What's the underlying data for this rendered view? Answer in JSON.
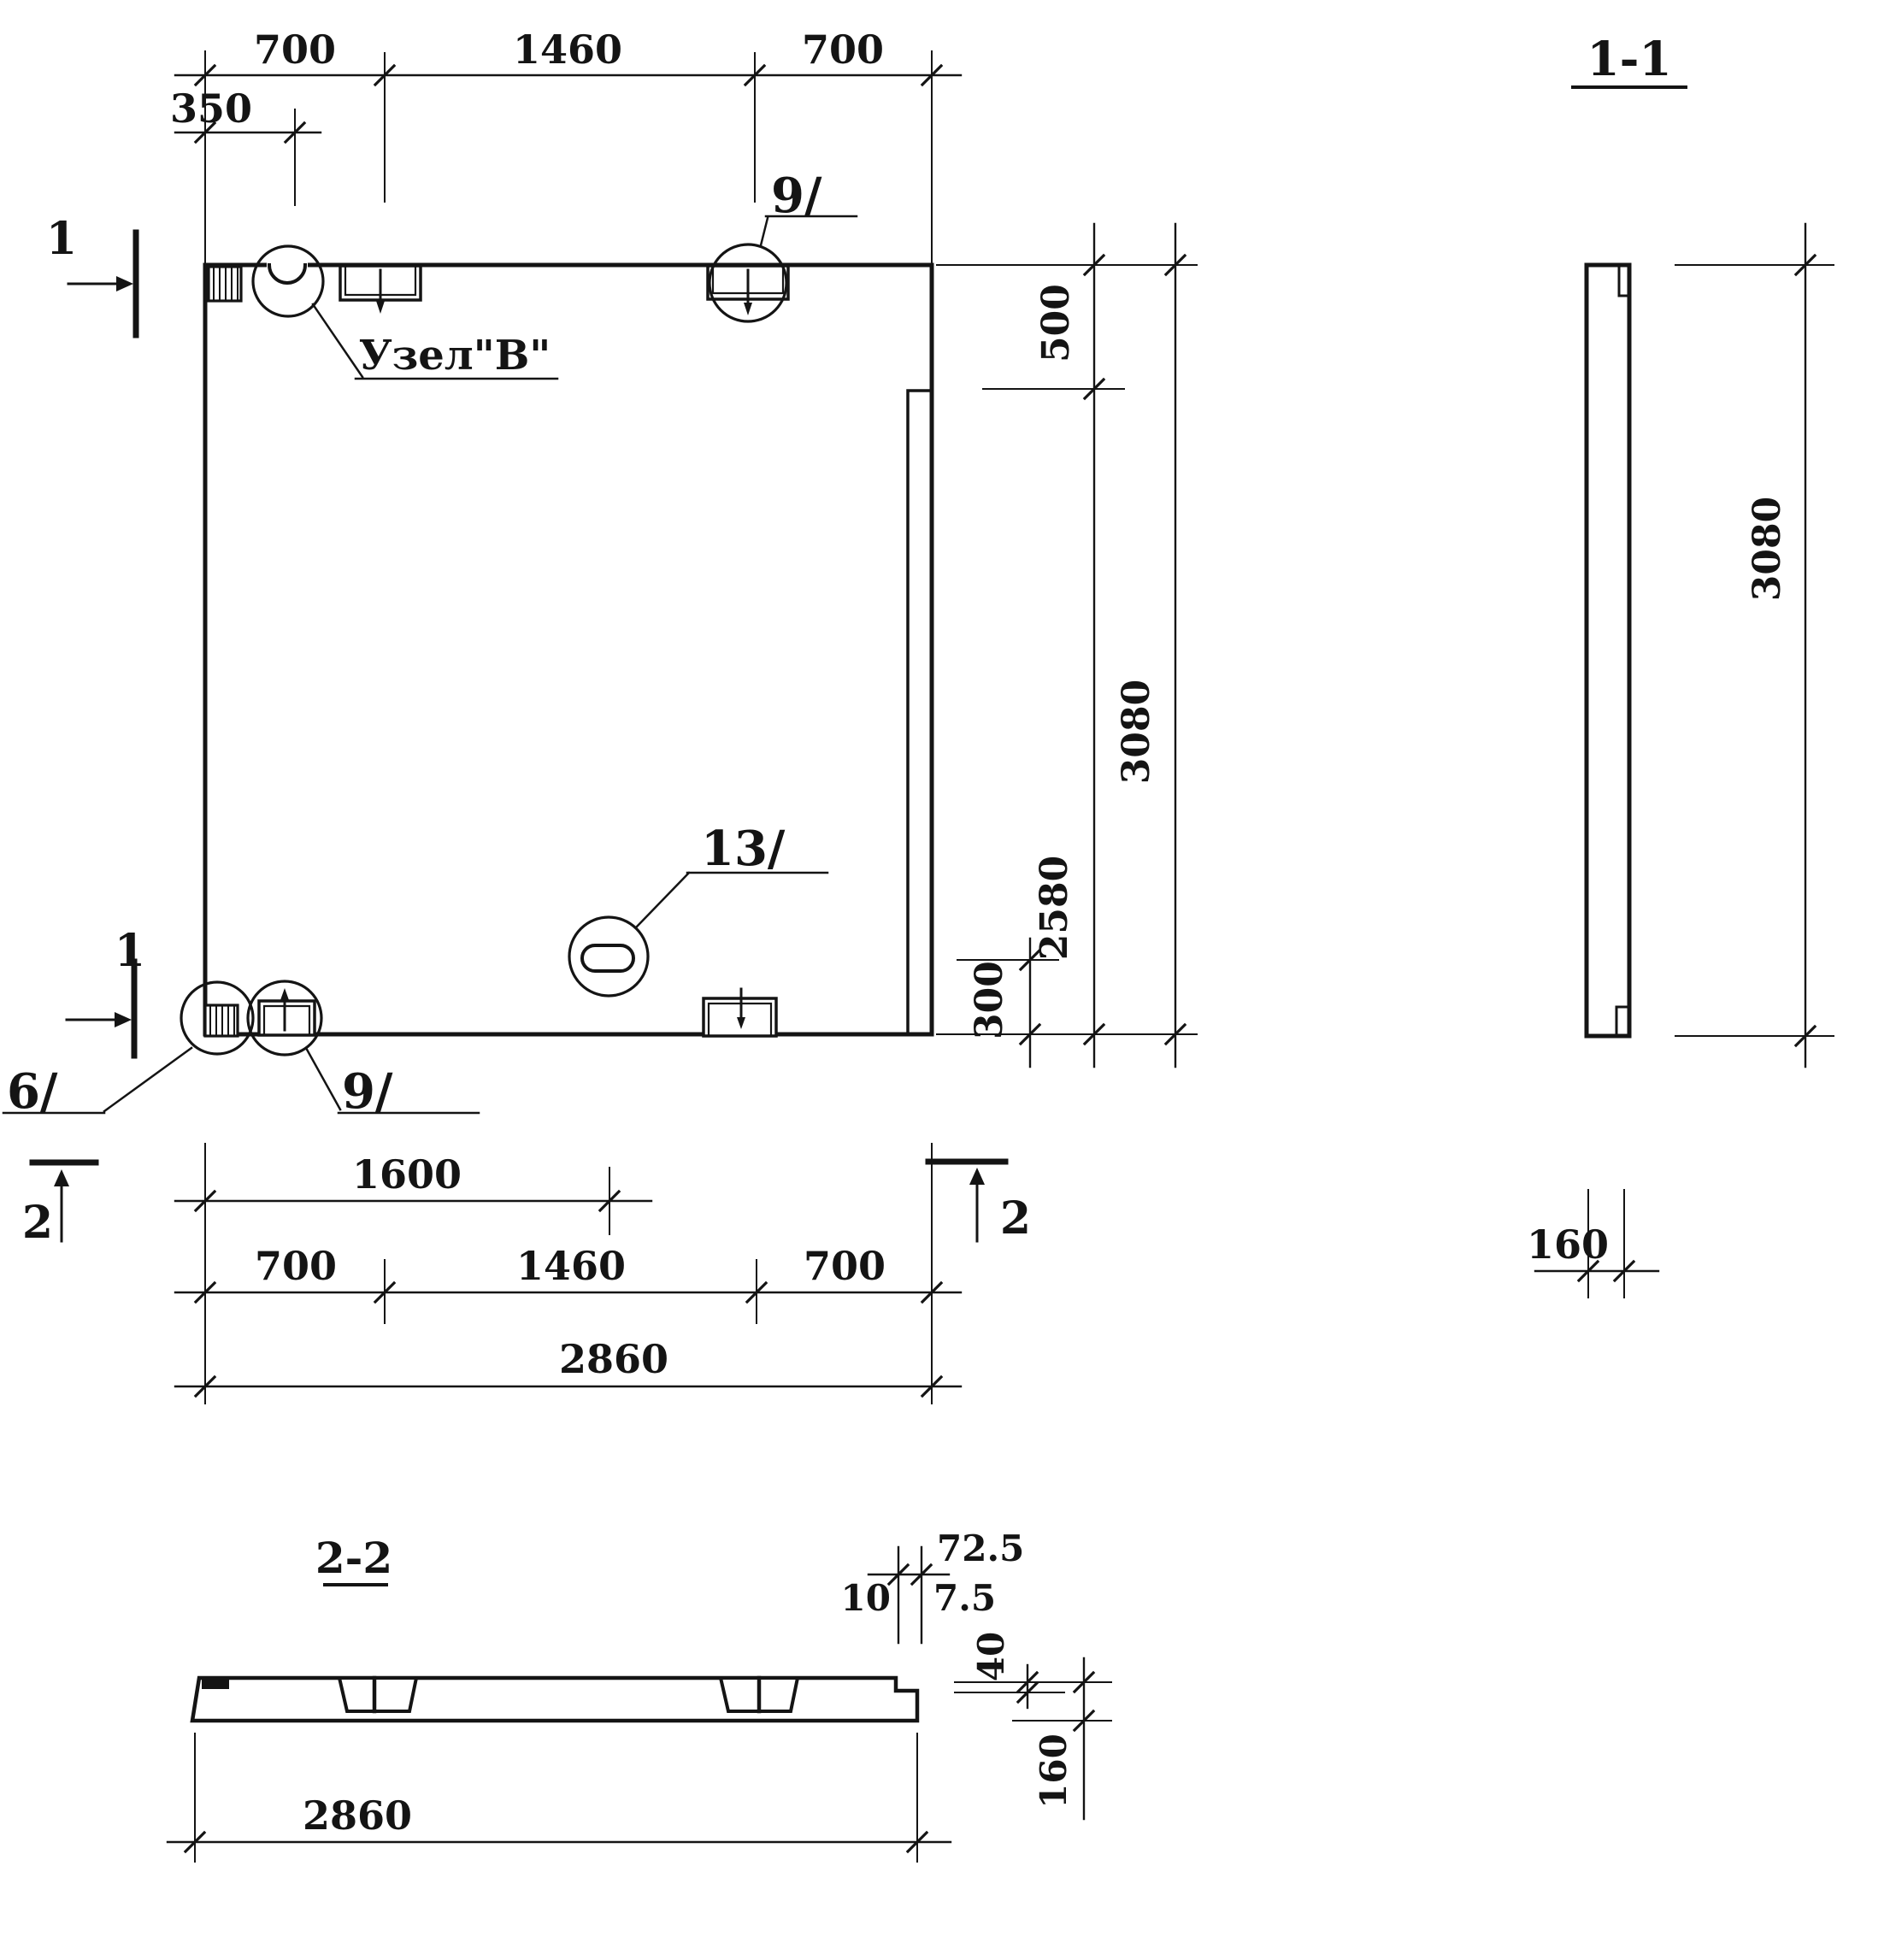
{
  "plan": {
    "node_label": "Узел\"В\"",
    "marker_1_top": "1",
    "marker_1_bottom": "1",
    "marker_2_left": "2",
    "marker_2_right": "2",
    "callout_plate_top": "9/",
    "callout_plate_bottom": "9/",
    "callout_corner": "6/",
    "callout_slot": "13/",
    "dim_top_left_700": "700",
    "dim_top_mid_1460": "1460",
    "dim_top_right_700": "700",
    "dim_top_350": "350",
    "dim_right_500": "500",
    "dim_right_2580": "2580",
    "dim_right_3080": "3080",
    "dim_right_300": "300",
    "dim_bottom_1600": "1600",
    "dim_bottom_left_700": "700",
    "dim_bottom_mid_1460": "1460",
    "dim_bottom_right_700": "700",
    "dim_bottom_2860": "2860"
  },
  "section_1_1": {
    "title": "1-1",
    "dim_3080": "3080",
    "dim_160": "160"
  },
  "section_2_2": {
    "title": "2-2",
    "dim_72_5": "72.5",
    "dim_10": "10",
    "dim_7_5": "7.5",
    "dim_40": "40",
    "dim_160": "160",
    "dim_2860": "2860"
  }
}
